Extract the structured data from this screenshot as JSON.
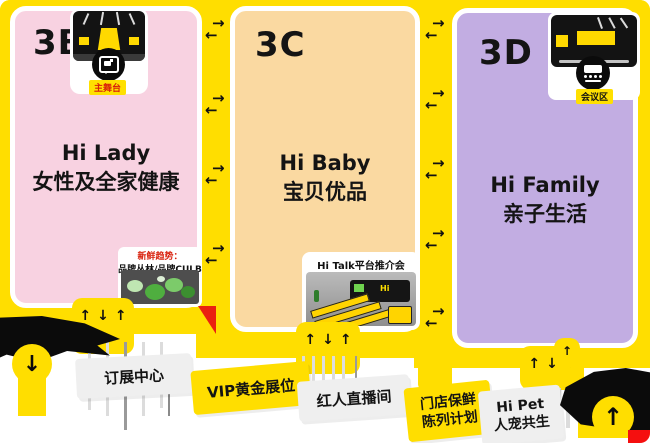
{
  "glyphs": {
    "up": "↑",
    "down": "↓",
    "left": "←",
    "right": "→"
  },
  "zones": {
    "b": {
      "id": "3B",
      "title": "Hi Lady",
      "subtitle": "女性及全家健康"
    },
    "c": {
      "id": "3C",
      "title": "Hi Baby",
      "subtitle": "宝贝优品"
    },
    "d": {
      "id": "3D",
      "title": "Hi Family",
      "subtitle": "亲子生活"
    }
  },
  "badges": {
    "main_stage": {
      "label": "主舞台"
    },
    "conference": {
      "label": "会议区"
    }
  },
  "callouts": {
    "fresh_trend": {
      "line1": "新鲜趋势：",
      "line2": "品牌丛林/品牌CULB"
    },
    "hi_talk": {
      "title": "Hi Talk平台推介会",
      "wall_logo": "Hi"
    }
  },
  "booths": {
    "order_center": {
      "label": "订展中心"
    },
    "vip": {
      "label": "VIP黄金展位"
    },
    "live_room": {
      "label": "红人直播间"
    },
    "store_fresh": {
      "line1": "门店保鲜",
      "line2": "陈列计划"
    },
    "hi_pet": {
      "line1": "Hi Pet",
      "line2": "人宠共生"
    }
  },
  "colors": {
    "yellow": "#FFDE00",
    "pink": "#F8D2E1",
    "peach": "#FAD9A1",
    "purple": "#C2ADE2",
    "red": "#EA2110",
    "grey_label": "#EFEFEF",
    "black": "#111111"
  }
}
